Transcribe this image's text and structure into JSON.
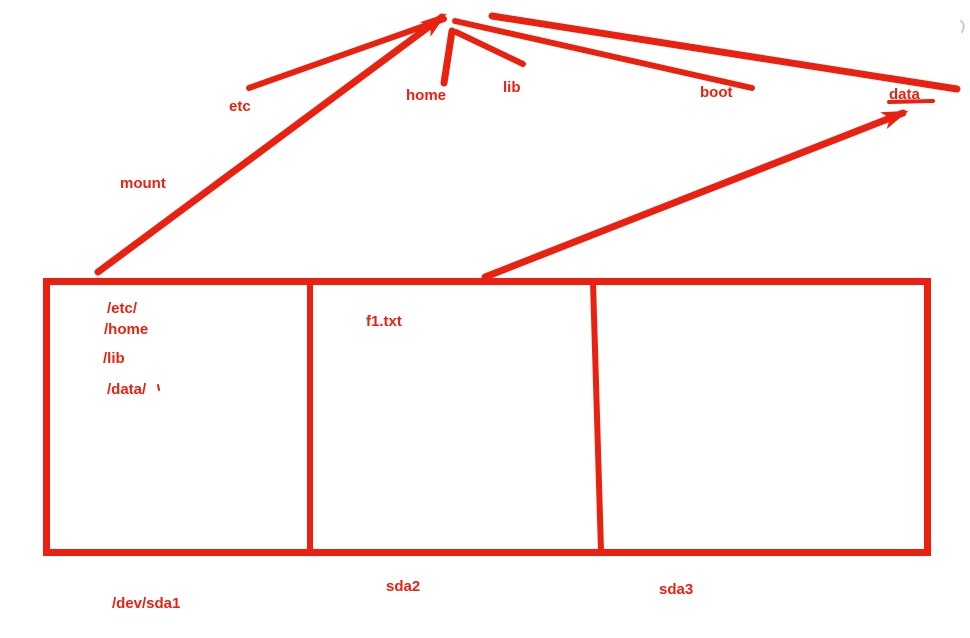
{
  "diagram": {
    "accent_color": "#ea2110",
    "mount_label": "mount",
    "root_dirs": {
      "etc": "etc",
      "home": "home",
      "lib": "lib",
      "boot": "boot",
      "data": "data"
    },
    "partitions": [
      {
        "device": "/dev/sda1",
        "contents": [
          "/etc/",
          "/home",
          "/lib",
          "/data/"
        ]
      },
      {
        "device": "sda2",
        "contents": [
          "f1.txt"
        ]
      },
      {
        "device": "sda3",
        "contents": []
      }
    ]
  }
}
